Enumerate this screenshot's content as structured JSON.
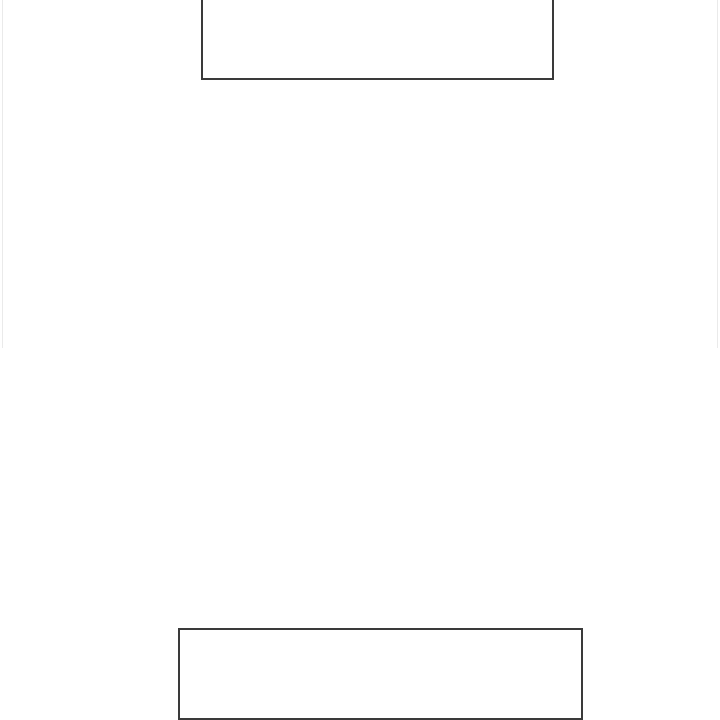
{
  "page": {
    "background_color": "#ffffff",
    "edge_line_color": "#eaeaea",
    "edge_line_height_px": 348
  },
  "form": {
    "top_field": {
      "value": "",
      "placeholder": ""
    },
    "bottom_field": {
      "value": "",
      "placeholder": ""
    }
  },
  "colors": {
    "box_border": "#3a3a3a"
  }
}
